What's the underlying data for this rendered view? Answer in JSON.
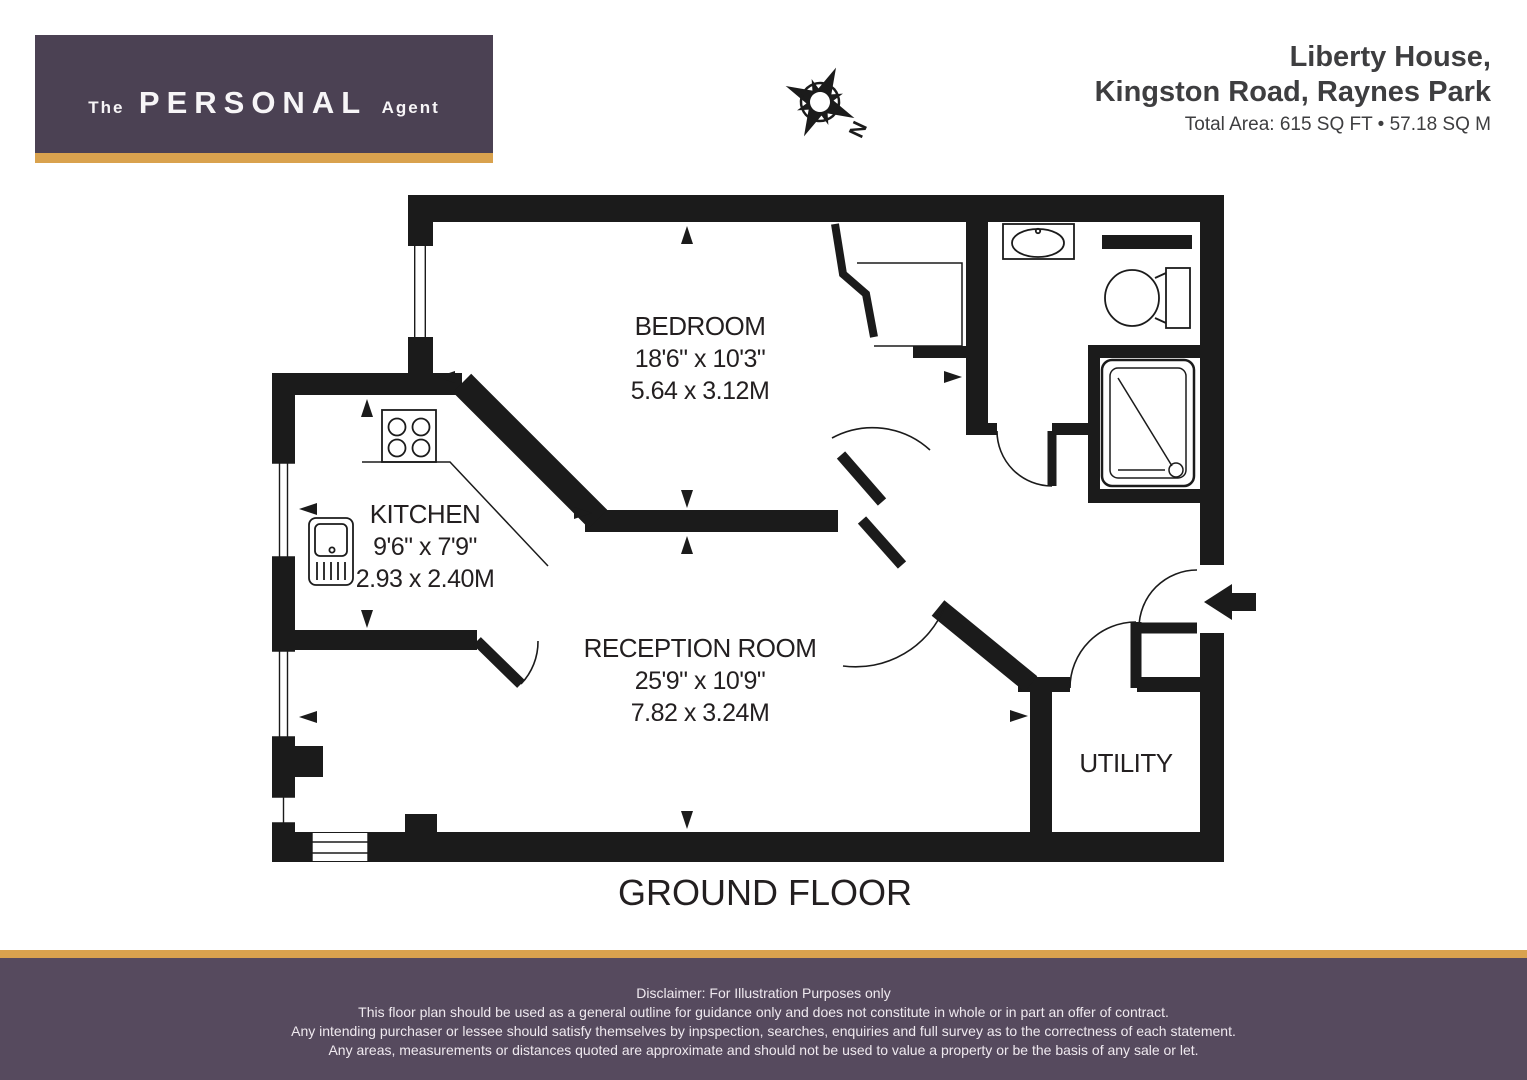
{
  "header": {
    "logo": {
      "the": "The",
      "main": "PERSONAL",
      "agent": "Agent"
    },
    "address_line1": "Liberty House,",
    "address_line2": "Kingston Road, Raynes Park",
    "total_area": "Total Area: 615 SQ FT • 57.18 SQ M",
    "compass_label": "N"
  },
  "rooms": {
    "bedroom": {
      "name": "BEDROOM",
      "imperial": "18'6\" x 10'3\"",
      "metric": "5.64 x 3.12M"
    },
    "kitchen": {
      "name": "KITCHEN",
      "imperial": "9'6\" x 7'9\"",
      "metric": "2.93 x 2.40M"
    },
    "reception": {
      "name": "RECEPTION ROOM",
      "imperial": "25'9\" x 10'9\"",
      "metric": "7.82 x 3.24M"
    },
    "utility": {
      "name": "UTILITY"
    }
  },
  "floor_label": "GROUND FLOOR",
  "footer": {
    "line1": "Disclaimer: For Illustration Purposes only",
    "line2": "This floor plan should be used as a general outline for guidance only and does not constitute in whole or in part an offer of contract.",
    "line3": "Any intending purchaser or lessee should satisfy themselves by inpspection, searches, enquiries and full survey as to the correctness of each statement.",
    "line4": "Any areas, measurements or distances quoted are approximate and should not be used to value a property or be the basis of any sale or let."
  },
  "icons": {
    "compass": "compass-rose-icon",
    "entry_arrow": "entry-arrow-icon",
    "hob": "hob-icon",
    "kitchen_sink": "kitchen-sink-icon",
    "basin": "basin-icon",
    "toilet": "toilet-icon",
    "shower": "shower-icon"
  },
  "colors": {
    "brand_purple": "#4b4153",
    "brand_gold": "#d9a24e",
    "footer_purple": "#564a5e",
    "plan_black": "#1b1b1b"
  }
}
